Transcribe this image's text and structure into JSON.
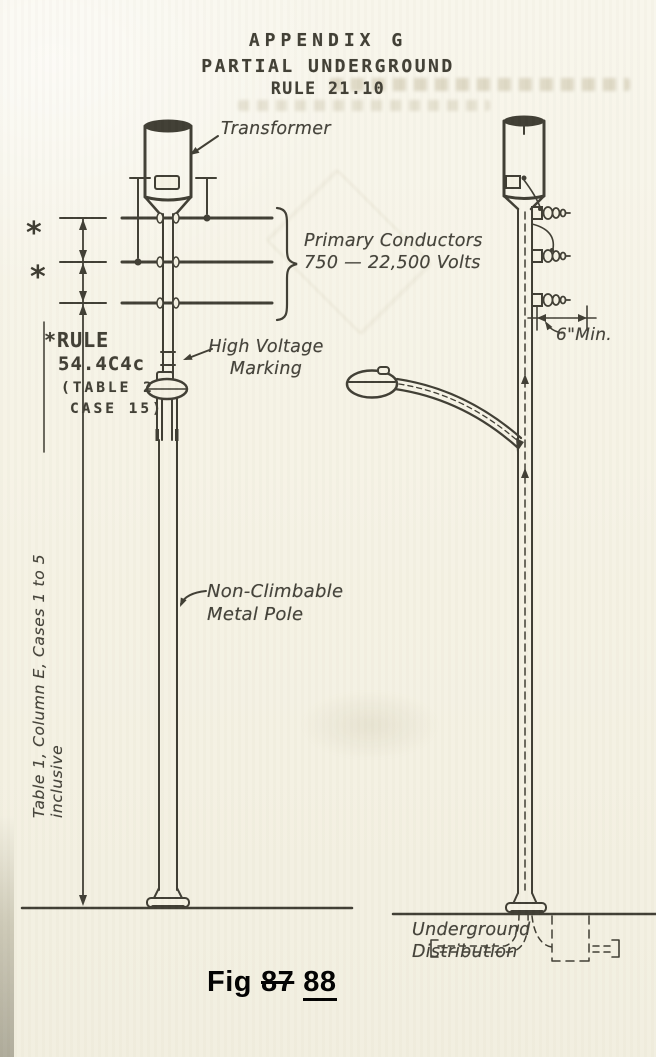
{
  "header": {
    "lines": [
      "APPENDIX G",
      "PARTIAL UNDERGROUND",
      "RULE 21.10"
    ]
  },
  "labels": {
    "transformer": "Transformer",
    "primary_conductors": "Primary Conductors\n750 — 22,500 Volts",
    "rule_note": [
      "*RULE",
      "54.4C4c",
      "(TABLE 2",
      "CASE 15)"
    ],
    "high_voltage_marking": "High Voltage\nMarking",
    "non_climbable": "Non-Climbable\nMetal Pole",
    "table_reference": "Table 1, Column E, Cases 1 to 5 inclusive",
    "six_inch_min": "6\"Min.",
    "underground": "Underground\nDistribution",
    "asterisk": "*"
  },
  "figure_caption": {
    "prefix": "Fig",
    "old_number": "87",
    "new_number": "88"
  },
  "colors": {
    "paper": "#f5f2e4",
    "ink": "#3f3d33",
    "caption": "#000000"
  }
}
